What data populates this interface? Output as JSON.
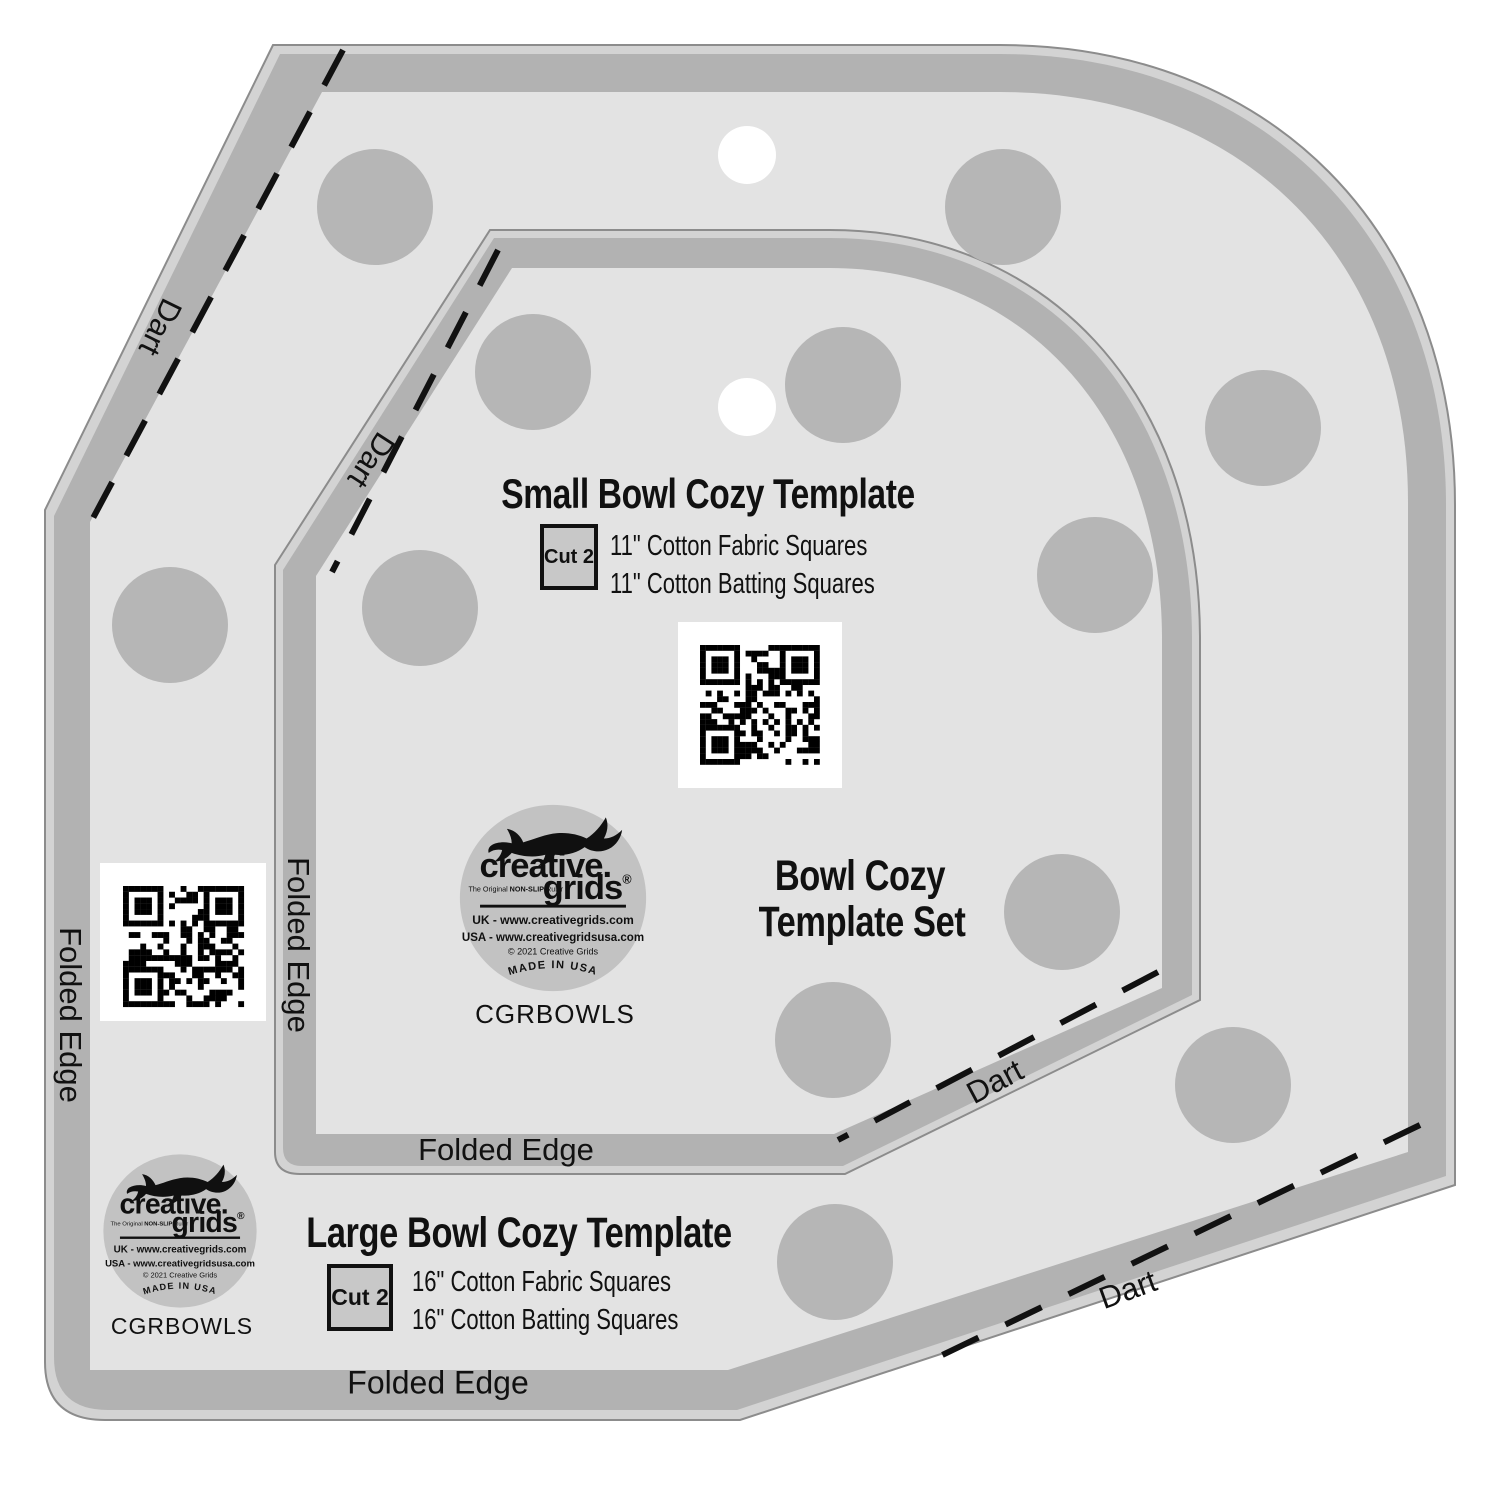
{
  "set_title": {
    "line1": "Bowl Cozy",
    "line2": "Template Set"
  },
  "small_template": {
    "title": "Small Bowl Cozy Template",
    "cut_label": "Cut 2",
    "spec_line1": "11\" Cotton Fabric Squares",
    "spec_line2": "11\" Cotton Batting Squares"
  },
  "large_template": {
    "title": "Large Bowl Cozy Template",
    "cut_label": "Cut 2",
    "spec_line1": "16\" Cotton Fabric Squares",
    "spec_line2": "16\" Cotton Batting Squares"
  },
  "labels": {
    "dart": "Dart",
    "folded_edge": "Folded Edge"
  },
  "sku": "CGRBOWLS",
  "logo": {
    "brand_line1": "creative.",
    "brand_line2": "grids",
    "registered": "®",
    "tagline_pre": "The Original ",
    "tagline_bold": "NON-SLIP",
    "tagline_post": " Ruler",
    "uk_line": "UK - www.creativegrids.com",
    "usa_line": "USA - www.creativegridsusa.com",
    "copyright_line": "© 2021  Creative Grids",
    "made_in": "MADE IN USA"
  },
  "colors": {
    "background": "#ffffff",
    "bevel": "#d3d3d3",
    "band": "#b2b2b2",
    "interior": "#e3e3e3",
    "grip_dot": "#b6b6b6",
    "logo_bg": "#c2c2c2",
    "text": "#111111"
  }
}
